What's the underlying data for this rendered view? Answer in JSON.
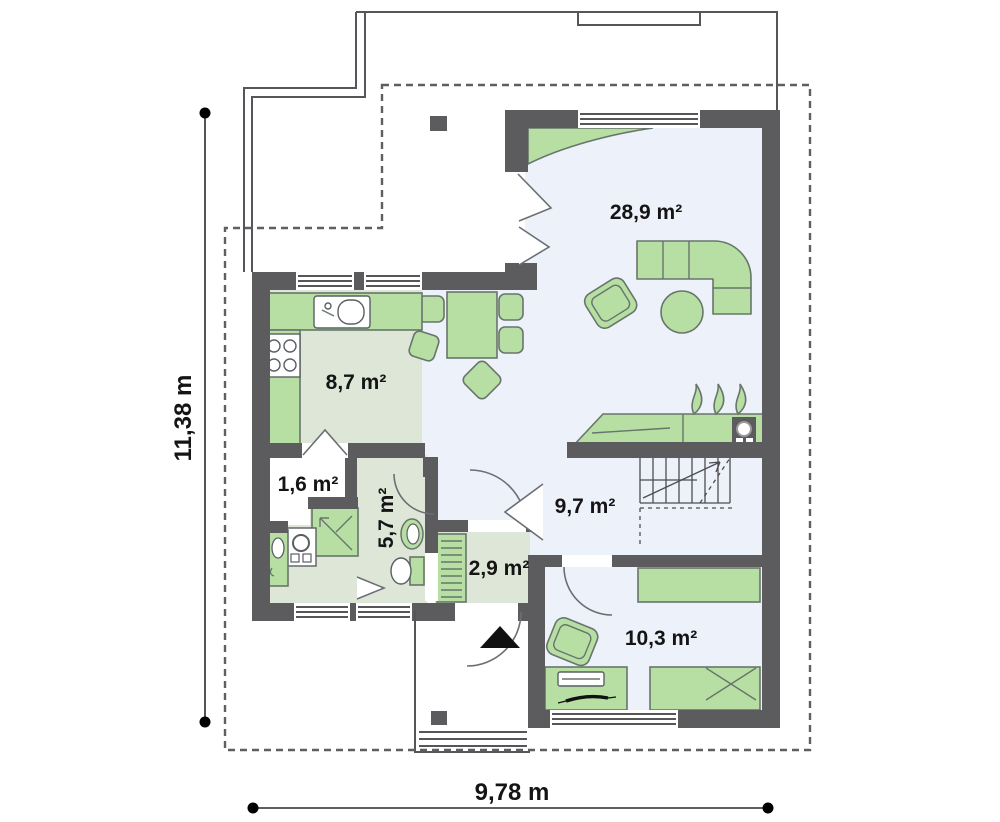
{
  "plan": {
    "rooms": [
      {
        "id": "living-room",
        "area_label": "28,9 m²"
      },
      {
        "id": "kitchen",
        "area_label": "8,7 m²"
      },
      {
        "id": "pantry",
        "area_label": "1,6 m²"
      },
      {
        "id": "bathroom",
        "area_label": "5,7 m²"
      },
      {
        "id": "vestibule",
        "area_label": "2,9 m²"
      },
      {
        "id": "hall",
        "area_label": "9,7 m²"
      },
      {
        "id": "bedroom",
        "area_label": "10,3 m²"
      }
    ],
    "dimensions": {
      "height": "11,38 m",
      "width": "9,78 m"
    },
    "colors": {
      "wall": "#5c5c5e",
      "floor_main": "#edf1fa",
      "floor_service": "#dde6d7",
      "furniture": "#b7dfa3",
      "furniture_outline": "#68756b",
      "entrance_arrow": "#111111"
    }
  }
}
